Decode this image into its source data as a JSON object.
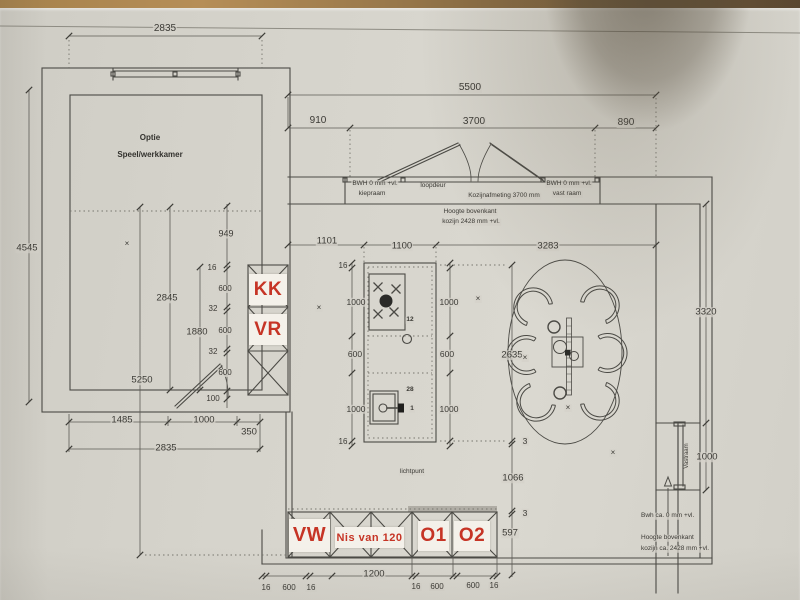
{
  "colors": {
    "red_label_text": "#c63425",
    "label_background": "#f4f1ea",
    "line": "#4b4a45",
    "paper": "#d5d3cb",
    "wood_table": "#a5824e"
  },
  "room": {
    "line1": "Optie",
    "line2": "Speel/werkkamer"
  },
  "red_labels": [
    {
      "t": "KK",
      "x": 249,
      "y": 274,
      "w": 38,
      "h": 31,
      "fs": 19
    },
    {
      "t": "VR",
      "x": 249,
      "y": 314,
      "w": 38,
      "h": 31,
      "fs": 19
    },
    {
      "t": "VW",
      "x": 289,
      "y": 519,
      "w": 41,
      "h": 33,
      "fs": 20
    },
    {
      "t": "Nis van 120",
      "x": 335,
      "y": 527,
      "w": 69,
      "h": 21,
      "fs": 11
    },
    {
      "t": "O1",
      "x": 418,
      "y": 521,
      "w": 31,
      "h": 30,
      "fs": 19
    },
    {
      "t": "O2",
      "x": 454,
      "y": 521,
      "w": 36,
      "h": 30,
      "fs": 19
    }
  ],
  "annotations": [
    {
      "t": "2835",
      "x": 165,
      "y": 29
    },
    {
      "t": "5500",
      "x": 470,
      "y": 88
    },
    {
      "t": "910",
      "x": 318,
      "y": 121
    },
    {
      "t": "3700",
      "x": 474,
      "y": 122
    },
    {
      "t": "890",
      "x": 626,
      "y": 123
    },
    {
      "t": "BWH 0 mm +vl.",
      "x": 375,
      "y": 184,
      "fs": 6.5
    },
    {
      "t": "kiepraam",
      "x": 372,
      "y": 194,
      "fs": 6.5
    },
    {
      "t": "loopdeur",
      "x": 433,
      "y": 186,
      "fs": 6.5
    },
    {
      "t": "Kozijnafmeting 3700 mm",
      "x": 504,
      "y": 196,
      "fs": 6.5
    },
    {
      "t": "BWH 0 mm +vl.",
      "x": 569,
      "y": 184,
      "fs": 6.5
    },
    {
      "t": "vast raam",
      "x": 567,
      "y": 194,
      "fs": 6.5
    },
    {
      "t": "Hoogte bovenkant",
      "x": 470,
      "y": 212,
      "fs": 6.5
    },
    {
      "t": "kozijn 2428 mm +vl.",
      "x": 471,
      "y": 222,
      "fs": 6.5
    },
    {
      "t": "4545",
      "x": 27,
      "y": 248,
      "fs": 9.5
    },
    {
      "t": "949",
      "x": 226,
      "y": 234,
      "fs": 9
    },
    {
      "t": "1101",
      "x": 327,
      "y": 241,
      "fs": 9.5
    },
    {
      "t": "1100",
      "x": 402,
      "y": 246,
      "fs": 9.5
    },
    {
      "t": "3283",
      "x": 548,
      "y": 246,
      "fs": 9.5
    },
    {
      "t": "3320",
      "x": 706,
      "y": 312,
      "fs": 9.5
    },
    {
      "t": "16",
      "x": 212,
      "y": 268,
      "fs": 8
    },
    {
      "t": "600",
      "x": 225,
      "y": 289,
      "fs": 8
    },
    {
      "t": "32",
      "x": 213,
      "y": 309,
      "fs": 8
    },
    {
      "t": "2845",
      "x": 167,
      "y": 298,
      "fs": 9.5
    },
    {
      "t": "1880",
      "x": 197,
      "y": 332,
      "fs": 9.5
    },
    {
      "t": "600",
      "x": 225,
      "y": 331,
      "fs": 8
    },
    {
      "t": "32",
      "x": 213,
      "y": 352,
      "fs": 8
    },
    {
      "t": "600",
      "x": 225,
      "y": 373,
      "fs": 8
    },
    {
      "t": "100",
      "x": 213,
      "y": 399,
      "fs": 8
    },
    {
      "t": "5250",
      "x": 142,
      "y": 380,
      "fs": 9.5
    },
    {
      "t": "1485",
      "x": 122,
      "y": 420,
      "fs": 9.5
    },
    {
      "t": "1000",
      "x": 204,
      "y": 420,
      "fs": 9.5
    },
    {
      "t": "350",
      "x": 249,
      "y": 432,
      "fs": 9.5
    },
    {
      "t": "2835",
      "x": 166,
      "y": 448,
      "fs": 9.5
    },
    {
      "t": "16",
      "x": 343,
      "y": 266,
      "fs": 8
    },
    {
      "t": "1000",
      "x": 356,
      "y": 302,
      "fs": 8.5
    },
    {
      "t": "600",
      "x": 355,
      "y": 354,
      "fs": 8.5
    },
    {
      "t": "1000",
      "x": 356,
      "y": 409,
      "fs": 8.5
    },
    {
      "t": "16",
      "x": 343,
      "y": 442,
      "fs": 8
    },
    {
      "t": "1000",
      "x": 449,
      "y": 302,
      "fs": 8.5
    },
    {
      "t": "600",
      "x": 447,
      "y": 354,
      "fs": 8.5
    },
    {
      "t": "1000",
      "x": 449,
      "y": 409,
      "fs": 8.5
    },
    {
      "t": "12",
      "x": 410,
      "y": 320,
      "fs": 6.5,
      "b": 1
    },
    {
      "t": "28",
      "x": 410,
      "y": 390,
      "fs": 6.5,
      "b": 1
    },
    {
      "t": "1",
      "x": 412,
      "y": 409,
      "fs": 6.5,
      "b": 1
    },
    {
      "t": "2635",
      "x": 512,
      "y": 355,
      "fs": 9.5
    },
    {
      "t": "3",
      "x": 525,
      "y": 441,
      "fs": 8.5
    },
    {
      "t": "1066",
      "x": 513,
      "y": 478,
      "fs": 9.5
    },
    {
      "t": "3",
      "x": 525,
      "y": 513,
      "fs": 8.5
    },
    {
      "t": "597",
      "x": 510,
      "y": 533,
      "fs": 9.5
    },
    {
      "t": "lichtpunt",
      "x": 412,
      "y": 472,
      "fs": 6.5
    },
    {
      "t": "1200",
      "x": 374,
      "y": 574,
      "fs": 9.5
    },
    {
      "t": "16",
      "x": 266,
      "y": 588,
      "fs": 8
    },
    {
      "t": "600",
      "x": 289,
      "y": 588,
      "fs": 8
    },
    {
      "t": "16",
      "x": 311,
      "y": 588,
      "fs": 8
    },
    {
      "t": "16",
      "x": 416,
      "y": 587,
      "fs": 8
    },
    {
      "t": "600",
      "x": 437,
      "y": 587,
      "fs": 8
    },
    {
      "t": "600",
      "x": 473,
      "y": 586,
      "fs": 8
    },
    {
      "t": "16",
      "x": 494,
      "y": 586,
      "fs": 8
    },
    {
      "t": "Bwh ca. 0 mm +vl.",
      "x": 640,
      "y": 516,
      "fs": 6.5,
      "al": "l"
    },
    {
      "t": "Hoogte bovenkant",
      "x": 640,
      "y": 538,
      "fs": 6.5,
      "al": "l"
    },
    {
      "t": "kozijn ca. 2428 mm +vl.",
      "x": 640,
      "y": 549,
      "fs": 6.5,
      "al": "l"
    },
    {
      "t": "Vastraam",
      "x": 687,
      "y": 456,
      "fs": 6,
      "rot": -90
    },
    {
      "t": "1000",
      "x": 707,
      "y": 457,
      "fs": 9.5
    },
    {
      "t": "×",
      "x": 127,
      "y": 244,
      "fs": 8
    },
    {
      "t": "×",
      "x": 319,
      "y": 308,
      "fs": 8
    },
    {
      "t": "×",
      "x": 478,
      "y": 299,
      "fs": 8
    },
    {
      "t": "×",
      "x": 525,
      "y": 358,
      "fs": 8
    },
    {
      "t": "×",
      "x": 568,
      "y": 408,
      "fs": 8
    },
    {
      "t": "×",
      "x": 613,
      "y": 453,
      "fs": 8
    }
  ]
}
